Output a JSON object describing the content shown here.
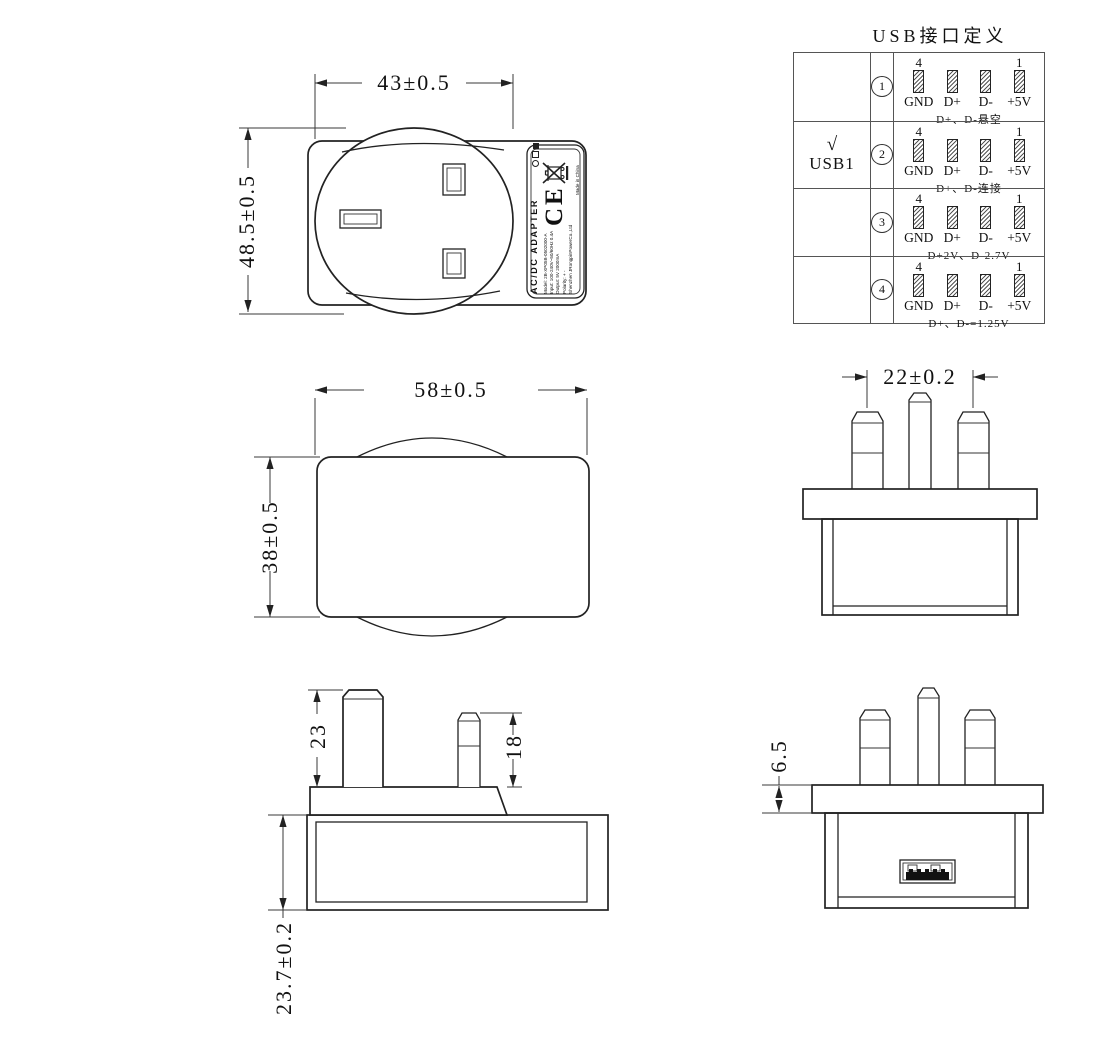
{
  "table": {
    "title": "USB接口定义",
    "pin_left_num": "4",
    "pin_right_num": "1",
    "pin_labels": [
      "GND",
      "D+",
      "D-",
      "+5V"
    ],
    "rows": [
      {
        "selected": "",
        "port": "",
        "index": "1",
        "note": "D+、D-悬空"
      },
      {
        "selected": "√",
        "port": "USB1",
        "index": "2",
        "note": "D+、D-连接"
      },
      {
        "selected": "",
        "port": "",
        "index": "3",
        "note": "D+2V、D-2.7V"
      },
      {
        "selected": "",
        "port": "",
        "index": "4",
        "note": "D+、D-=1.25V"
      }
    ]
  },
  "dimensions": {
    "face_width": "43±0.5",
    "face_height": "48.5±0.5",
    "body_width": "58±0.5",
    "body_height": "38±0.5",
    "pin_spacing": "22±0.2",
    "earth_pin_length": "23",
    "line_pin_length": "18",
    "body_depth": "23.7±0.2",
    "flange_thickness": "6.5"
  },
  "label": {
    "product": "AC/DC ADAPTER",
    "ce_mark": "CE",
    "made_in": "Made in China",
    "lines": [
      "Model: 2B-XP05B-0502000-A",
      "Input: 100-240V~50/60Hz 0.4A",
      "Output: 5V 2000mA",
      "Polarity: + -",
      "Shenzhen JRongpinPowerCo.,Ltd"
    ]
  }
}
